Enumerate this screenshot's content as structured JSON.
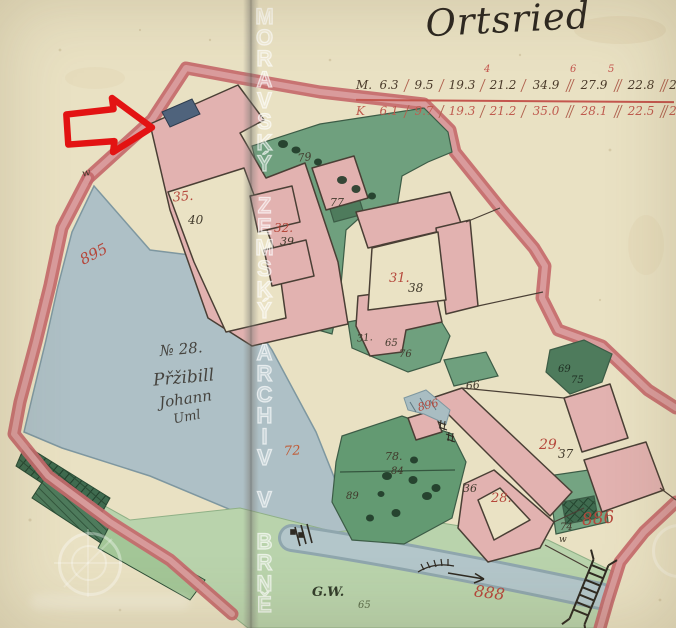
{
  "title": "Ortsried",
  "watermark": {
    "archive_text": "MORAVSKÝ ZEMSKÝ ARCHIV V BRNĚ"
  },
  "scale_table": {
    "row_m_label": "M.",
    "row_k_label": "K",
    "row_m": [
      "6.3",
      "9.5",
      "19.3",
      "21.2",
      "34.9",
      "27.9",
      "22.8",
      "2"
    ],
    "row_k": [
      "6.1",
      "9.7",
      "19.3",
      "21.2",
      "35.0",
      "28.1",
      "22.5",
      "2"
    ],
    "superscripts": [
      "4",
      "6",
      "5"
    ]
  },
  "field_note": {
    "line1": "№ 28.",
    "line2": "Přžibill",
    "line3": "Johann",
    "line4": "Uml"
  },
  "labels": {
    "h35": "35.",
    "p40": "40",
    "h32": "32.",
    "p39": "39",
    "h31": "31.",
    "p38": "38",
    "h29": "29.",
    "p37": "37",
    "h28": "28.",
    "p36": "36",
    "g79": "79",
    "g77": "77",
    "g31b": "31.",
    "g65": "65",
    "g76": "76",
    "g66": "66",
    "g69": "69",
    "g75": "75",
    "g74": "74",
    "g74w": "w",
    "g78": "78.",
    "g84": "84",
    "g89": "89",
    "f72": "72",
    "gw": "G.W.",
    "g65b": "65",
    "w_left": "w",
    "r895": "895",
    "r896": "896",
    "r886": "886",
    "r888": "888"
  },
  "colors": {
    "paper": "#e9e1c3",
    "boundary_band": "#c4696b",
    "building_pink": "#e2b2b0",
    "garden_green": "#6fa07e",
    "dark_green": "#4e7b5c",
    "meadow_green": "#b9d3ac",
    "water_blue": "#aec0c6",
    "red_ink": "#b5473b",
    "dark_ink": "#413a2c",
    "annotation_arrow_red": "#e31313",
    "arrow_target_blue": "#4f637c"
  }
}
